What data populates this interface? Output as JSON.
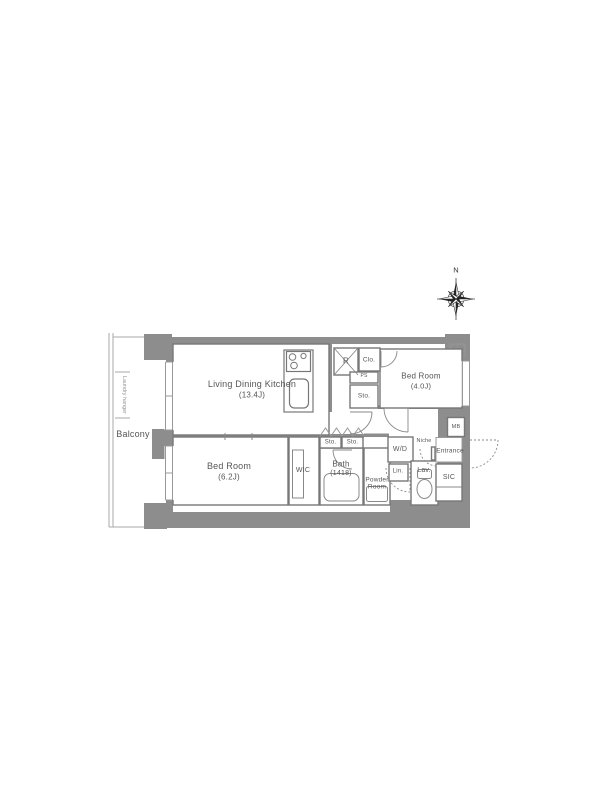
{
  "plan": {
    "compass": {
      "north": "N"
    },
    "balcony": {
      "label": "Balcony",
      "laundry_hanger": "Laundry hanger"
    },
    "rooms": {
      "ldk": {
        "name": "Living Dining Kitchen",
        "area": "(13.4J)"
      },
      "bedroom_east": {
        "name": "Bed Room",
        "area": "(4.0J)"
      },
      "bedroom_west": {
        "name": "Bed Room",
        "area": "(6.2J)"
      },
      "bath": {
        "name": "Bath",
        "area": "(1418)"
      },
      "powder_room": {
        "name": "Powder Room"
      },
      "wic": {
        "name": "WIC"
      },
      "sic": {
        "name": "SIC"
      },
      "entrance": {
        "name": "Entrance"
      }
    },
    "fixtures": {
      "refrigerator": "R",
      "closet": "Clo.",
      "pipe_space": "PS",
      "storage_hall": "Sto.",
      "storage_left": "Sto.",
      "storage_right": "Sto.",
      "washer_dryer": "W/D",
      "linen": "Lin.",
      "lavatory": "Lav.",
      "niche": "Niche",
      "meter_box": "MB"
    },
    "colors": {
      "background": "#ffffff",
      "wall": "#8d8d8d",
      "line": "#777777",
      "light_line": "#999999",
      "text": "#555555",
      "compass": "#222222"
    }
  }
}
